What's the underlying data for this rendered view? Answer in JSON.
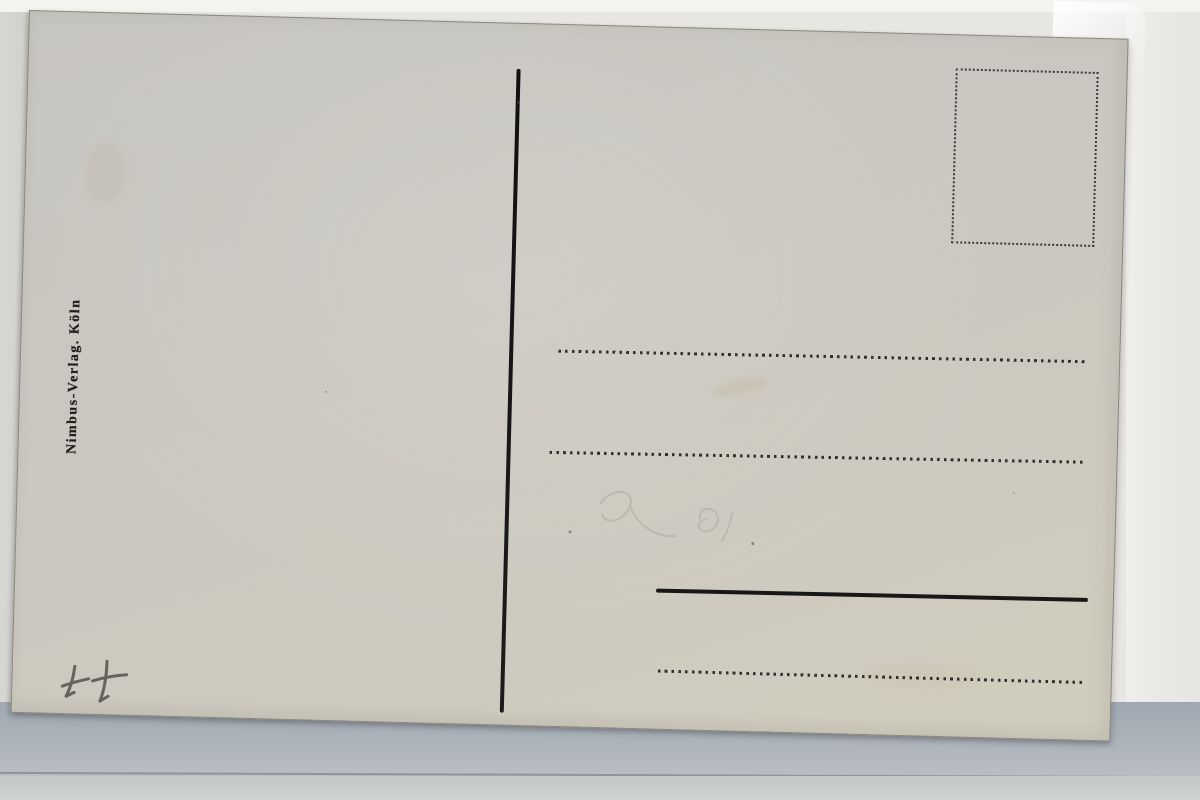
{
  "postcard": {
    "publisher_imprint": "Nimbus-Verlag. Köln",
    "pencil_annotation": "++",
    "address_field": {
      "line_styles": [
        "dotted",
        "dotted",
        "solid",
        "dotted"
      ],
      "dotted_line_count": 3,
      "solid_line_count": 1
    },
    "stamp_box_style": "dotted-rectangle",
    "divider_style": "solid-vertical-line"
  },
  "colors": {
    "ink": "#1c1c1c",
    "card_surface": "#cac7c0",
    "card_surface_bottom": "#d1cdbe",
    "backdrop_right": "#eceae7",
    "backdrop_left_strip": "#d2d2cf",
    "backdrop_top_strip": "#f4f3f0",
    "bottom_band": "#a8afb8",
    "bottom_band_light": "#c8cecd",
    "pencil": "#5d5a53"
  }
}
